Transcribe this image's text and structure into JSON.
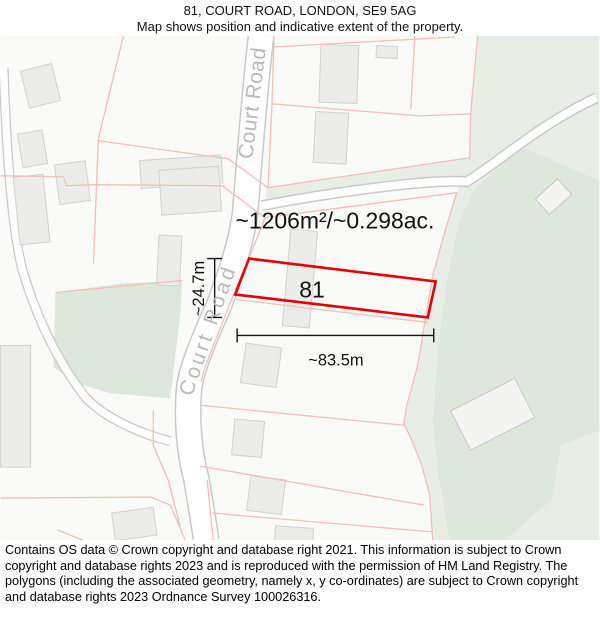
{
  "header": {
    "title": "81, COURT ROAD, LONDON, SE9 5AG",
    "subtitle": "Map shows position and indicative extent of the property."
  },
  "map": {
    "plot": {
      "number": "81",
      "area_label": "~1206m²/~0.298ac.",
      "width_label": "~83.5m",
      "depth_label": "~24.7m"
    },
    "roads": {
      "upper_label": "Court Road",
      "lower_label": "Court Road"
    },
    "colors": {
      "plot_outline_red": "#e60000",
      "boundary_pink": "#f5bdb6",
      "green_light": "#e8eee5",
      "green_dark": "#dee7db",
      "road_casing": "#c9c9c9",
      "road_fill": "#ffffff",
      "building_fill": "#ececeb",
      "building_stroke": "#d2d2d0",
      "road_label_gray": "#b9b9b9",
      "map_background": "#fafaf9"
    }
  },
  "footer": {
    "text": "Contains OS data © Crown copyright and database right 2021. This information is subject to Crown copyright and database rights 2023 and is reproduced with the permission of HM Land Registry. The polygons (including the associated geometry, namely x, y co-ordinates) are subject to Crown copyright and database rights 2023 Ordnance Survey 100026316."
  }
}
